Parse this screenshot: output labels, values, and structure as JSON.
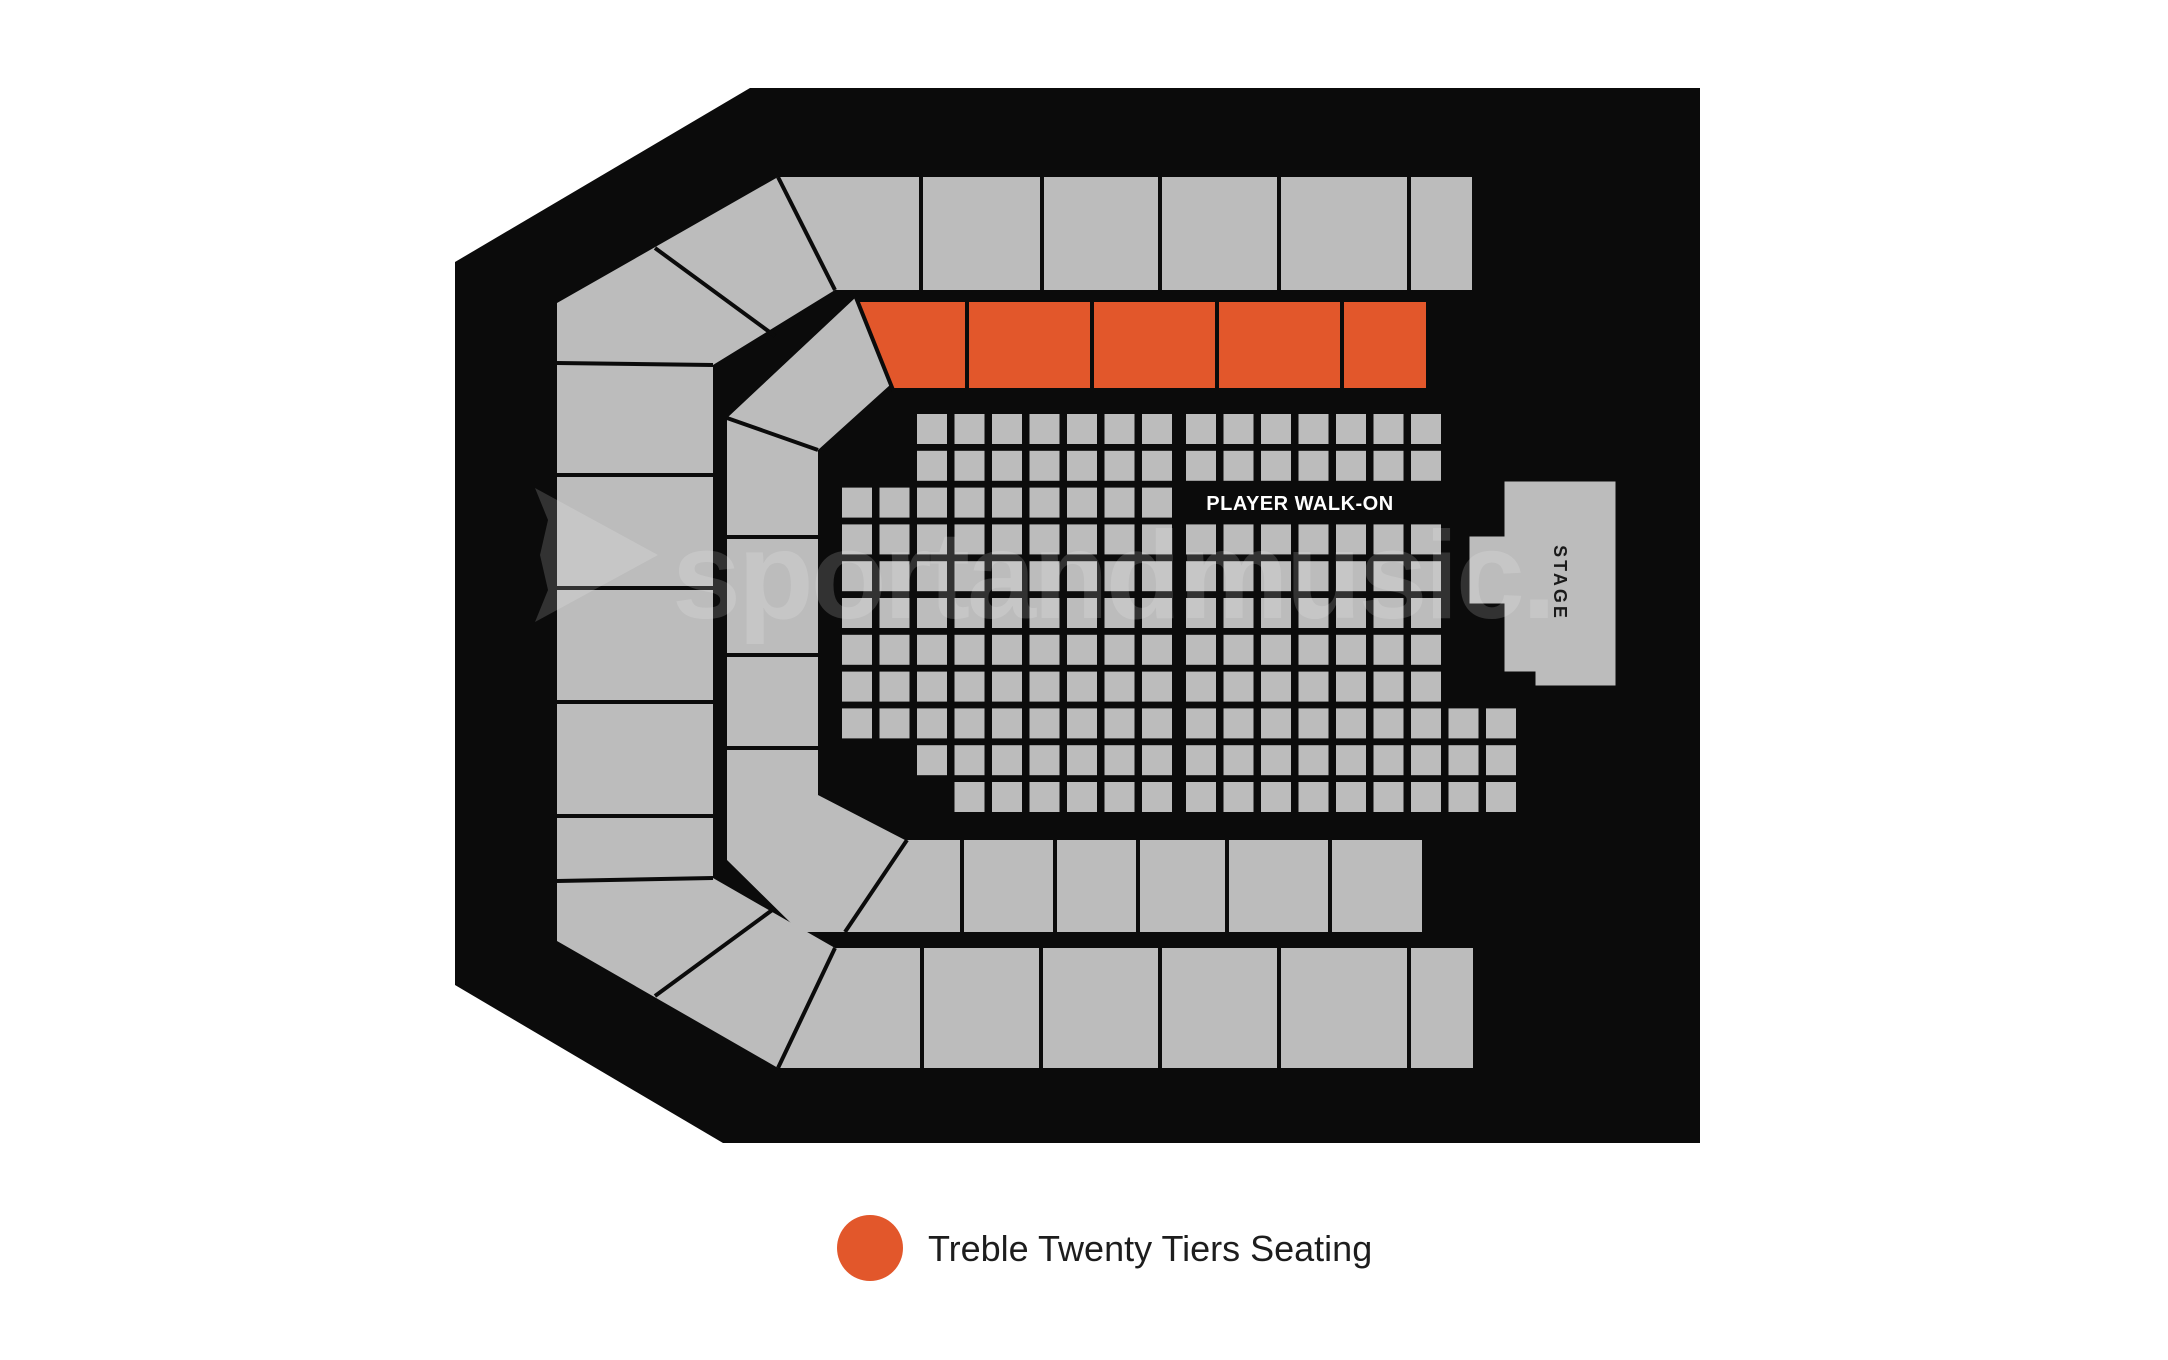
{
  "canvas": {
    "width": 2168,
    "height": 1360,
    "background": "#ffffff"
  },
  "colors": {
    "arena": "#0b0b0b",
    "section": "#bcbcbc",
    "divider": "#0b0b0b",
    "highlight": "#e2572b",
    "walkon_text": "#ffffff",
    "stage_text": "#1a1a1a",
    "legend_text": "#1d1d1d",
    "watermark": "rgba(255,255,255,0.16)"
  },
  "labels": {
    "player_walk_on": "PLAYER WALK-ON",
    "stage": "STAGE"
  },
  "watermark": {
    "text": "sportandmusic."
  },
  "legend": {
    "label": "Treble Twenty Tiers Seating"
  },
  "floor": {
    "size": 30,
    "col_pitch": 37.5,
    "row_pitch": 36.8,
    "left_block": {
      "x0": 842,
      "y0": 414,
      "rows": [
        [
          0,
          2,
          8
        ],
        [
          1,
          2,
          8
        ],
        [
          2,
          0,
          8
        ],
        [
          3,
          0,
          8
        ],
        [
          4,
          0,
          8
        ],
        [
          5,
          0,
          8
        ],
        [
          6,
          0,
          8
        ],
        [
          7,
          0,
          8
        ],
        [
          8,
          0,
          8
        ],
        [
          9,
          2,
          8
        ],
        [
          10,
          3,
          8
        ]
      ]
    },
    "right_block": {
      "x0": 1186,
      "y0": 414,
      "rows": [
        [
          0,
          0,
          6
        ],
        [
          1,
          0,
          6
        ],
        [
          3,
          0,
          6
        ],
        [
          4,
          0,
          6
        ],
        [
          5,
          0,
          6
        ],
        [
          6,
          0,
          6
        ],
        [
          7,
          0,
          6
        ],
        [
          8,
          0,
          8
        ],
        [
          9,
          0,
          8
        ],
        [
          10,
          0,
          8
        ]
      ]
    }
  }
}
